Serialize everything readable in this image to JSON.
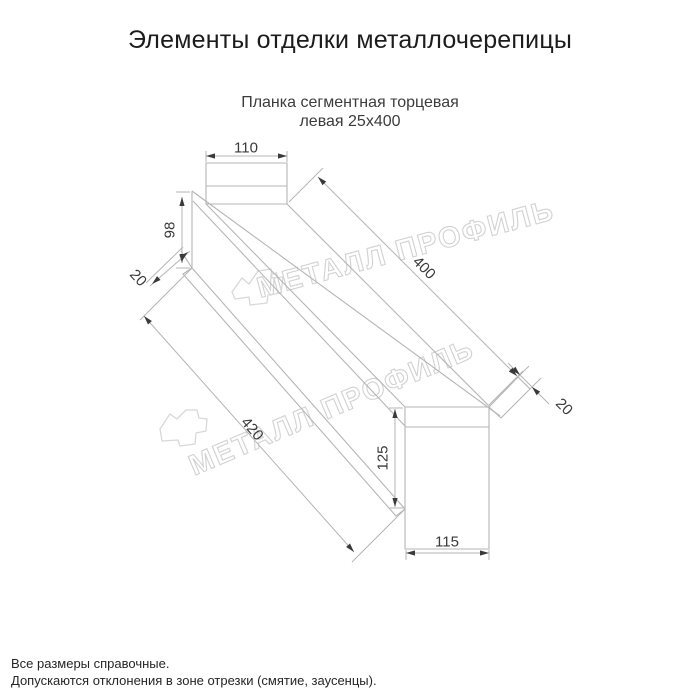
{
  "title": "Элементы отделки металлочерепицы",
  "subtitle": {
    "line1": "Планка сегментная торцевая",
    "line2": "левая 25х400"
  },
  "dimensions": {
    "top_width": "110",
    "left_height": "98",
    "left_hem": "20",
    "length_top": "400",
    "length_bottom": "420",
    "right_hem": "20",
    "right_height": "125",
    "bottom_width": "115"
  },
  "watermark": {
    "text": "МЕТАЛЛ ПРОФИЛЬ"
  },
  "footer": {
    "line1": "Все размеры справочные.",
    "line2": "Допускаются отклонения в зоне отрезки (смятие, заусенцы)."
  },
  "colors": {
    "line": "#b5b5b5",
    "arrow": "#3a3a3a",
    "dim_text": "#3a3a3a",
    "watermark": "#d2d2d2"
  }
}
